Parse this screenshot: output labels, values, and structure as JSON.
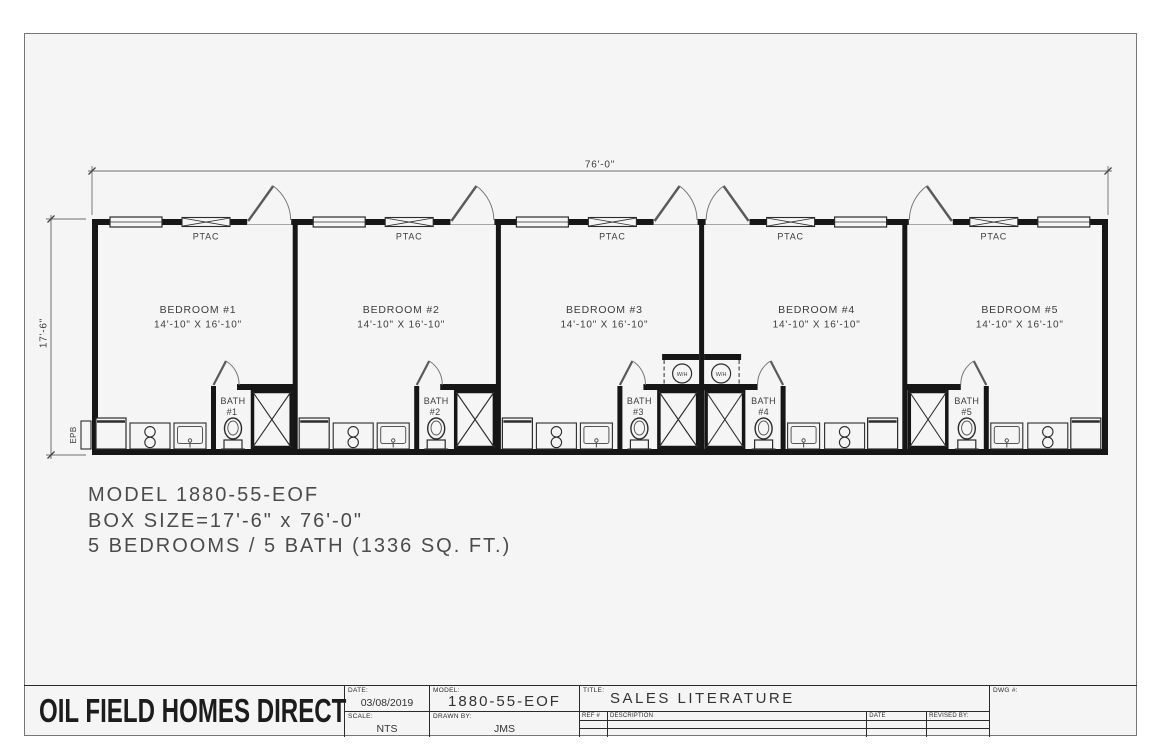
{
  "colors": {
    "sheet_background": "#f5f5f5",
    "wall": "#161616",
    "line": "#2c2c2c",
    "dim_line": "#6f6f6f",
    "text": "#3d3d3d"
  },
  "floorplan": {
    "width_dim": "76'-0\"",
    "height_dim": "17'-6\"",
    "ptac_label": "PTAC",
    "wh_label": "W/H",
    "epb_label": "EPB",
    "units": [
      {
        "bedroom": "BEDROOM #1",
        "size": "14'-10\" X 16'-10\"",
        "bath_line1": "BATH",
        "bath_line2": "#1",
        "mirrored": false
      },
      {
        "bedroom": "BEDROOM #2",
        "size": "14'-10\" X 16'-10\"",
        "bath_line1": "BATH",
        "bath_line2": "#2",
        "mirrored": false
      },
      {
        "bedroom": "BEDROOM #3",
        "size": "14'-10\" X 16'-10\"",
        "bath_line1": "BATH",
        "bath_line2": "#3",
        "mirrored": false
      },
      {
        "bedroom": "BEDROOM #4",
        "size": "14'-10\" X 16'-10\"",
        "bath_line1": "BATH",
        "bath_line2": "#4",
        "mirrored": true
      },
      {
        "bedroom": "BEDROOM #5",
        "size": "14'-10\" X 16'-10\"",
        "bath_line1": "BATH",
        "bath_line2": "#5",
        "mirrored": true
      }
    ]
  },
  "notes": {
    "line1": "MODEL 1880-55-EOF",
    "line2": "BOX SIZE=17'-6\" x 76'-0\"",
    "line3": "5 BEDROOMS / 5 BATH (1336 SQ. FT.)"
  },
  "titleblock": {
    "company": "OIL FIELD HOMES DIRECT",
    "date_label": "DATE:",
    "date_value": "03/08/2019",
    "scale_label": "SCALE:",
    "scale_value": "NTS",
    "model_label": "MODEL:",
    "model_value": "1880-55-EOF",
    "drawn_by_label": "DRAWN BY:",
    "drawn_by_value": "JMS",
    "title_label": "TITLE:",
    "title_value": "SALES LITERATURE",
    "dwg_label": "DWG #:",
    "rev_headers": [
      "REF #",
      "DESCRIPTION",
      "DATE",
      "REVISED BY:"
    ],
    "rev_rows": [
      [
        "",
        "",
        "",
        ""
      ],
      [
        "",
        "",
        "",
        ""
      ]
    ]
  }
}
